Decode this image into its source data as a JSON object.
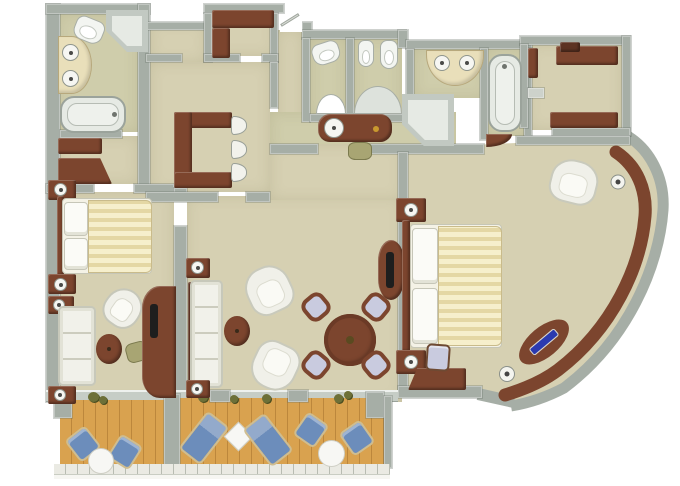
{
  "scene": {
    "type": "3d-rendered-floor-plan",
    "width_px": 680,
    "height_px": 486
  },
  "palette": {
    "background": "#ffffff",
    "wall": "#a6aea6",
    "wall_light": "#cdd2cb",
    "carpet": "#d6d0b2",
    "carpet_bath": "#cfcdab",
    "wood_cabinet": "#7c452e",
    "wood_dark": "#5d3323",
    "white_furniture": "#f1f1ea",
    "vanity_cream": "#e9dfba",
    "duvet_stripe_a": "#f6efcc",
    "duvet_stripe_b": "#e4d7a4",
    "deck_wood": "#d9a24f",
    "deck_line": "#bc873c",
    "lounger_blue": "#6c8dbb",
    "chair_lavender": "#c9cbdf",
    "stool_green": "#a8a573",
    "accent_blue": "#2b3ab0",
    "brass": "#c9992f",
    "railing": "#eaeae3"
  },
  "rooms": [
    {
      "name": "master-bathroom",
      "furniture": [
        "double-sink-vanity",
        "toilet",
        "corner-shower",
        "bathtub"
      ]
    },
    {
      "name": "dressing-area",
      "furniture": [
        "wardrobe",
        "wardrobe"
      ]
    },
    {
      "name": "master-bedroom",
      "furniture": [
        "double-bed",
        "nightstand-with-lamp",
        "nightstand-with-lamp",
        "sofa",
        "side-table-with-lamp",
        "side-table-with-lamp",
        "tub-chair",
        "oval-coffee-table",
        "stool",
        "tv-desk-cabinet"
      ]
    },
    {
      "name": "entry-hall",
      "furniture": [
        "bar-counter",
        "bar-stool",
        "bar-stool",
        "bar-stool",
        "entry-closet"
      ]
    },
    {
      "name": "guest-bathroom",
      "furniture": [
        "toilet",
        "bidet",
        "toilet",
        "wall-basin",
        "soaking-tub",
        "corner-shower",
        "dressing-console-with-basin",
        "stool",
        "double-sink-vanity",
        "bathtub"
      ]
    },
    {
      "name": "walk-in-closet",
      "furniture": [
        "counter",
        "side-cabinet",
        "shelf",
        "bench"
      ]
    },
    {
      "name": "living-room",
      "furniture": [
        "sofa",
        "side-table-with-lamp",
        "side-table-with-lamp",
        "armchair",
        "armchair",
        "oval-coffee-table",
        "round-dining-table",
        "dining-chair",
        "dining-chair",
        "dining-chair",
        "dining-chair",
        "tv-console"
      ]
    },
    {
      "name": "second-bedroom",
      "furniture": [
        "double-bed",
        "nightstand-with-lamp",
        "nightstand-with-lamp",
        "armchair",
        "desk",
        "desk-chair",
        "curved-window-console",
        "console-lamp",
        "console-lamp",
        "blue-inlay-daybed-cushion"
      ]
    },
    {
      "name": "balcony",
      "sections": [
        {
          "name": "balcony-left",
          "furniture": [
            "deck-chair",
            "deck-chair",
            "round-table"
          ]
        },
        {
          "name": "balcony-right",
          "furniture": [
            "sun-lounger",
            "diamond-table",
            "sun-lounger",
            "deck-chair",
            "round-table",
            "deck-chair"
          ]
        }
      ]
    }
  ]
}
